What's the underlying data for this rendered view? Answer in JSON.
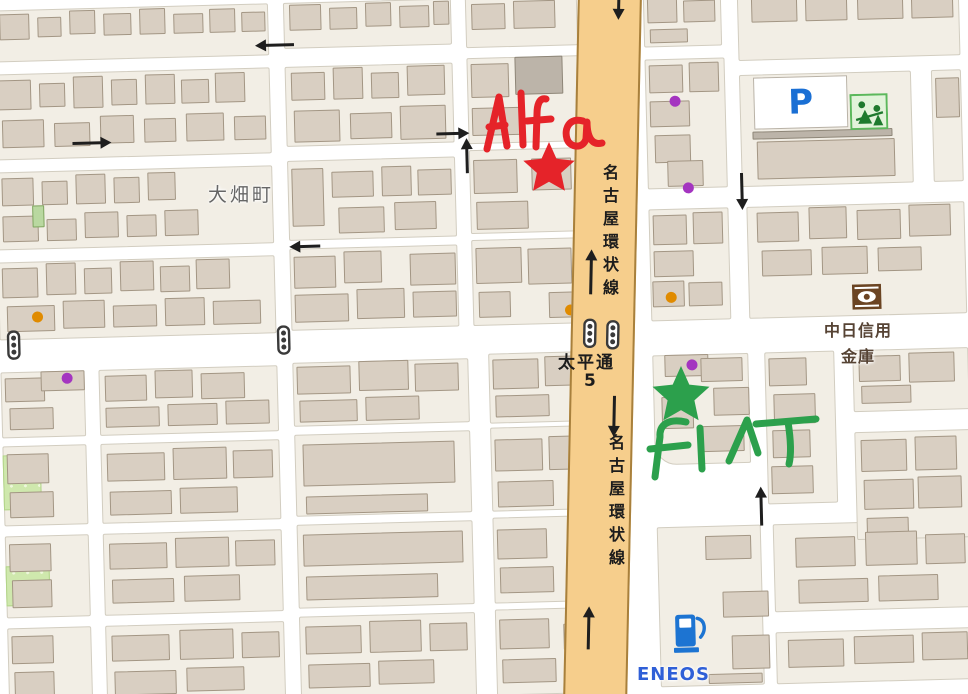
{
  "labels": {
    "town": "大畑町",
    "road_name": "名古屋環状線",
    "intersection_name": "太平通",
    "intersection_number": "5",
    "bank_line1": "中日信用",
    "bank_line2": "金庫",
    "parking": "P",
    "gas_station": "ENEOS"
  },
  "annotations": {
    "red_label": "Alfa",
    "green_label": "FIAT",
    "red_color": "#e52329",
    "green_color": "#2ca04c",
    "red_star": {
      "cx": 549,
      "cy": 169,
      "R": 27
    },
    "green_star": {
      "cx": 681,
      "cy": 396,
      "R": 30
    },
    "red_strokes": [
      "M487,149 L499,97 L507,146",
      "M489,127 L505,125",
      "M521,93 L523,145",
      "M546,99 C539,97 537,106 537,114 L536,147",
      "M527,121 L551,119",
      "M583,121 C569,117 564,129 567,139 C570,148 583,149 586,139 L587,122 C587,135 591,146 602,143"
    ],
    "green_strokes": [
      "M686,422 C668,418 659,425 660,437 L655,477",
      "M650,449 L688,445",
      "M700,428 L702,469",
      "M729,461 L747,420 L758,453",
      "M756,424 L816,419",
      "M788,422 C791,441 791,456 789,464"
    ]
  },
  "palette": {
    "street": "#ffffff",
    "block": "#f2eee5",
    "building": "#d9cfc2",
    "road": "#f6ce8c",
    "road_border": "#a8803c",
    "dot_orange": "#e08b00",
    "dot_purple": "#a435c0",
    "label_gray": "#666666",
    "bank_text": "#564334",
    "blue": "#2f5fd7",
    "icon_green": "#3f9e3f"
  },
  "geometry": {
    "road": {
      "x": 578,
      "y": -10,
      "w": 64,
      "h": 714,
      "rot": 1.2
    },
    "blocks": [
      [
        0,
        0,
        277,
        52
      ],
      [
        292,
        0,
        168,
        46
      ],
      [
        474,
        0,
        112,
        50
      ],
      [
        0,
        64,
        277,
        86
      ],
      [
        292,
        64,
        168,
        80
      ],
      [
        474,
        60,
        112,
        86
      ],
      [
        0,
        162,
        277,
        78
      ],
      [
        292,
        158,
        168,
        80
      ],
      [
        474,
        152,
        112,
        84
      ],
      [
        0,
        252,
        277,
        78
      ],
      [
        292,
        246,
        168,
        82
      ],
      [
        474,
        242,
        112,
        86
      ],
      [
        0,
        362,
        84,
        66
      ],
      [
        98,
        362,
        179,
        66
      ],
      [
        292,
        360,
        176,
        64
      ],
      [
        488,
        356,
        100,
        70
      ],
      [
        0,
        436,
        84,
        80
      ],
      [
        98,
        436,
        179,
        80
      ],
      [
        292,
        432,
        176,
        82
      ],
      [
        488,
        430,
        100,
        84
      ],
      [
        0,
        526,
        84,
        82
      ],
      [
        98,
        526,
        179,
        82
      ],
      [
        292,
        522,
        176,
        84
      ],
      [
        488,
        520,
        100,
        86
      ],
      [
        0,
        618,
        84,
        80
      ],
      [
        98,
        618,
        179,
        80
      ],
      [
        292,
        614,
        176,
        84
      ],
      [
        488,
        612,
        100,
        86
      ],
      [
        652,
        0,
        78,
        54
      ],
      [
        746,
        0,
        222,
        70
      ],
      [
        652,
        66,
        80,
        130
      ],
      [
        746,
        84,
        172,
        112
      ],
      [
        938,
        84,
        30,
        112
      ],
      [
        652,
        216,
        80,
        112
      ],
      [
        750,
        216,
        218,
        112
      ],
      [
        652,
        362,
        96,
        110,
        "rbl"
      ],
      [
        764,
        362,
        70,
        152
      ],
      [
        852,
        362,
        116,
        62
      ],
      [
        852,
        444,
        116,
        108
      ],
      [
        652,
        534,
        104,
        160
      ],
      [
        768,
        534,
        200,
        88
      ],
      [
        768,
        642,
        200,
        52
      ]
    ],
    "green_areas": [
      [
        0,
        445,
        38,
        55
      ],
      [
        0,
        556,
        44,
        40
      ]
    ],
    "buildings": [
      [
        8,
        4,
        30,
        26
      ],
      [
        46,
        8,
        24,
        20
      ],
      [
        78,
        2,
        26,
        24
      ],
      [
        112,
        6,
        28,
        22
      ],
      [
        148,
        2,
        26,
        26
      ],
      [
        182,
        8,
        30,
        20
      ],
      [
        218,
        4,
        26,
        24
      ],
      [
        250,
        8,
        24,
        20
      ],
      [
        298,
        2,
        32,
        26
      ],
      [
        338,
        6,
        28,
        22
      ],
      [
        374,
        2,
        26,
        24
      ],
      [
        408,
        6,
        30,
        22
      ],
      [
        442,
        2,
        16,
        24
      ],
      [
        480,
        6,
        34,
        26
      ],
      [
        522,
        4,
        42,
        28
      ],
      [
        4,
        70,
        34,
        30
      ],
      [
        46,
        74,
        26,
        24
      ],
      [
        80,
        68,
        30,
        32
      ],
      [
        118,
        72,
        26,
        26
      ],
      [
        152,
        68,
        30,
        30
      ],
      [
        188,
        74,
        28,
        24
      ],
      [
        222,
        68,
        30,
        30
      ],
      [
        8,
        110,
        42,
        28
      ],
      [
        60,
        114,
        36,
        24
      ],
      [
        106,
        108,
        34,
        28
      ],
      [
        150,
        112,
        32,
        24
      ],
      [
        192,
        108,
        38,
        28
      ],
      [
        240,
        112,
        32,
        24
      ],
      [
        298,
        70,
        34,
        28
      ],
      [
        340,
        66,
        30,
        32
      ],
      [
        378,
        72,
        28,
        26
      ],
      [
        414,
        66,
        38,
        30
      ],
      [
        300,
        108,
        46,
        32
      ],
      [
        356,
        112,
        42,
        26
      ],
      [
        406,
        106,
        46,
        34
      ],
      [
        478,
        66,
        38,
        34
      ],
      [
        478,
        110,
        52,
        28
      ],
      [
        522,
        60,
        48,
        38,
        "gray"
      ],
      [
        6,
        168,
        32,
        28
      ],
      [
        46,
        172,
        26,
        24
      ],
      [
        80,
        166,
        30,
        30
      ],
      [
        118,
        170,
        26,
        26
      ],
      [
        152,
        166,
        28,
        28
      ],
      [
        6,
        206,
        36,
        26
      ],
      [
        50,
        210,
        30,
        22
      ],
      [
        88,
        204,
        34,
        26
      ],
      [
        130,
        208,
        30,
        22
      ],
      [
        168,
        204,
        34,
        26
      ],
      [
        36,
        196,
        12,
        22,
        "green"
      ],
      [
        296,
        166,
        32,
        58
      ],
      [
        336,
        170,
        42,
        26
      ],
      [
        386,
        166,
        30,
        30
      ],
      [
        422,
        170,
        34,
        26
      ],
      [
        342,
        206,
        46,
        26
      ],
      [
        398,
        202,
        42,
        28
      ],
      [
        478,
        162,
        44,
        34
      ],
      [
        480,
        204,
        52,
        28
      ],
      [
        536,
        162,
        40,
        32
      ],
      [
        4,
        258,
        36,
        30
      ],
      [
        48,
        254,
        30,
        32
      ],
      [
        86,
        260,
        28,
        26
      ],
      [
        122,
        254,
        34,
        30
      ],
      [
        162,
        260,
        30,
        26
      ],
      [
        198,
        254,
        34,
        30
      ],
      [
        8,
        296,
        48,
        26
      ],
      [
        64,
        292,
        42,
        28
      ],
      [
        114,
        298,
        44,
        22
      ],
      [
        166,
        292,
        40,
        28
      ],
      [
        214,
        296,
        48,
        24
      ],
      [
        296,
        254,
        42,
        32
      ],
      [
        346,
        250,
        38,
        32
      ],
      [
        296,
        292,
        54,
        28
      ],
      [
        358,
        288,
        48,
        30
      ],
      [
        412,
        254,
        46,
        32
      ],
      [
        414,
        292,
        44,
        26
      ],
      [
        478,
        250,
        46,
        36
      ],
      [
        480,
        294,
        32,
        26
      ],
      [
        530,
        252,
        44,
        36
      ],
      [
        550,
        296,
        32,
        26
      ],
      [
        4,
        368,
        40,
        24
      ],
      [
        8,
        398,
        44,
        22
      ],
      [
        40,
        362,
        44,
        20
      ],
      [
        104,
        368,
        42,
        26
      ],
      [
        154,
        364,
        38,
        28
      ],
      [
        200,
        368,
        44,
        26
      ],
      [
        104,
        400,
        54,
        20
      ],
      [
        166,
        398,
        50,
        22
      ],
      [
        224,
        396,
        44,
        24
      ],
      [
        296,
        364,
        54,
        28
      ],
      [
        358,
        360,
        50,
        30
      ],
      [
        414,
        364,
        44,
        28
      ],
      [
        298,
        398,
        58,
        22
      ],
      [
        364,
        396,
        54,
        24
      ],
      [
        492,
        362,
        46,
        30
      ],
      [
        494,
        398,
        54,
        22
      ],
      [
        544,
        360,
        38,
        30
      ],
      [
        4,
        444,
        42,
        30
      ],
      [
        6,
        482,
        44,
        26
      ],
      [
        104,
        446,
        58,
        28
      ],
      [
        170,
        442,
        54,
        32
      ],
      [
        230,
        446,
        40,
        28
      ],
      [
        106,
        484,
        62,
        24
      ],
      [
        176,
        482,
        58,
        26
      ],
      [
        300,
        442,
        152,
        42
      ],
      [
        302,
        494,
        122,
        18
      ],
      [
        492,
        442,
        48,
        32
      ],
      [
        494,
        484,
        56,
        26
      ],
      [
        546,
        440,
        34,
        34
      ],
      [
        4,
        534,
        42,
        28
      ],
      [
        6,
        570,
        40,
        28
      ],
      [
        104,
        536,
        58,
        26
      ],
      [
        170,
        532,
        54,
        30
      ],
      [
        230,
        536,
        40,
        26
      ],
      [
        106,
        572,
        62,
        24
      ],
      [
        178,
        570,
        56,
        26
      ],
      [
        298,
        532,
        160,
        32
      ],
      [
        300,
        574,
        132,
        24
      ],
      [
        492,
        532,
        50,
        30
      ],
      [
        494,
        570,
        54,
        26
      ],
      [
        4,
        626,
        42,
        28
      ],
      [
        6,
        662,
        40,
        26
      ],
      [
        104,
        628,
        58,
        26
      ],
      [
        172,
        624,
        54,
        30
      ],
      [
        234,
        628,
        38,
        26
      ],
      [
        106,
        664,
        62,
        24
      ],
      [
        178,
        662,
        58,
        24
      ],
      [
        298,
        624,
        56,
        28
      ],
      [
        362,
        620,
        52,
        32
      ],
      [
        422,
        624,
        38,
        28
      ],
      [
        300,
        662,
        62,
        24
      ],
      [
        370,
        660,
        56,
        24
      ],
      [
        492,
        622,
        50,
        30
      ],
      [
        556,
        628,
        30,
        26
      ],
      [
        494,
        662,
        54,
        24
      ],
      [
        656,
        4,
        30,
        26
      ],
      [
        692,
        8,
        32,
        22
      ],
      [
        658,
        36,
        38,
        14
      ],
      [
        760,
        2,
        46,
        30
      ],
      [
        814,
        6,
        42,
        26
      ],
      [
        866,
        2,
        46,
        30
      ],
      [
        920,
        6,
        42,
        26
      ],
      [
        656,
        72,
        34,
        28
      ],
      [
        696,
        70,
        30,
        30
      ],
      [
        656,
        108,
        40,
        26
      ],
      [
        660,
        142,
        36,
        28
      ],
      [
        672,
        168,
        36,
        26
      ],
      [
        758,
        141,
        140,
        8,
        "gray"
      ],
      [
        762,
        151,
        138,
        38
      ],
      [
        942,
        92,
        24,
        40
      ],
      [
        656,
        222,
        34,
        30
      ],
      [
        696,
        220,
        30,
        32
      ],
      [
        656,
        258,
        40,
        26
      ],
      [
        654,
        288,
        32,
        26
      ],
      [
        690,
        290,
        34,
        24
      ],
      [
        760,
        222,
        42,
        30
      ],
      [
        812,
        218,
        38,
        32
      ],
      [
        860,
        222,
        44,
        30
      ],
      [
        912,
        218,
        42,
        32
      ],
      [
        764,
        260,
        50,
        26
      ],
      [
        824,
        258,
        46,
        28
      ],
      [
        880,
        260,
        44,
        24
      ],
      [
        664,
        362,
        44,
        22
      ],
      [
        700,
        366,
        42,
        24
      ],
      [
        712,
        396,
        36,
        28
      ],
      [
        660,
        404,
        32,
        32
      ],
      [
        700,
        434,
        42,
        26
      ],
      [
        768,
        368,
        38,
        28
      ],
      [
        772,
        404,
        42,
        30
      ],
      [
        770,
        440,
        38,
        28
      ],
      [
        768,
        476,
        42,
        28
      ],
      [
        858,
        368,
        42,
        26
      ],
      [
        908,
        366,
        46,
        30
      ],
      [
        860,
        398,
        50,
        18
      ],
      [
        858,
        452,
        46,
        32
      ],
      [
        912,
        450,
        42,
        34
      ],
      [
        860,
        492,
        50,
        30
      ],
      [
        914,
        490,
        44,
        32
      ],
      [
        862,
        530,
        42,
        16
      ],
      [
        700,
        544,
        46,
        24
      ],
      [
        716,
        600,
        46,
        26
      ],
      [
        724,
        644,
        38,
        34
      ],
      [
        700,
        682,
        54,
        10
      ],
      [
        790,
        548,
        60,
        30
      ],
      [
        860,
        544,
        52,
        34
      ],
      [
        920,
        548,
        40,
        30
      ],
      [
        792,
        590,
        70,
        24
      ],
      [
        872,
        588,
        60,
        26
      ],
      [
        780,
        650,
        56,
        28
      ],
      [
        846,
        648,
        60,
        28
      ],
      [
        914,
        646,
        46,
        28
      ]
    ],
    "dots": [
      {
        "x": 33,
        "y": 302,
        "c": "orange"
      },
      {
        "x": 566,
        "y": 309,
        "c": "orange"
      },
      {
        "x": 667,
        "y": 299,
        "c": "orange"
      },
      {
        "x": 61,
        "y": 364,
        "c": "purple"
      },
      {
        "x": 676,
        "y": 103,
        "c": "purple"
      },
      {
        "x": 687,
        "y": 190,
        "c": "purple"
      },
      {
        "x": 686,
        "y": 367,
        "c": "purple"
      },
      {
        "x": 578,
        "y": 646,
        "c": "purple"
      }
    ],
    "traffic_lights": [
      {
        "x": 7,
        "y": 320
      },
      {
        "x": 277,
        "y": 322
      }
    ],
    "road_lights": [
      {
        "x": 10,
        "y": 328
      },
      {
        "x": 33,
        "y": 329
      }
    ],
    "arrows": [
      {
        "x": 283,
        "y": 42,
        "dir": "left",
        "len": 28
      },
      {
        "x": 97,
        "y": 135,
        "dir": "right",
        "len": 28
      },
      {
        "x": 458,
        "y": 135,
        "dir": "right",
        "len": 22
      },
      {
        "x": 472,
        "y": 158,
        "dir": "up",
        "len": 24
      },
      {
        "x": 308,
        "y": 244,
        "dir": "left",
        "len": 20
      },
      {
        "x": 746,
        "y": 200,
        "dir": "down",
        "len": 26
      },
      {
        "x": 757,
        "y": 516,
        "dir": "up",
        "len": 28
      }
    ],
    "road_arrows": [
      {
        "x": 39,
        "y": 16,
        "dir": "down",
        "len": 14
      },
      {
        "x": 17,
        "y": 282,
        "dir": "up",
        "len": 34
      },
      {
        "x": 43,
        "y": 425,
        "dir": "down",
        "len": 30
      },
      {
        "x": 22,
        "y": 638,
        "dir": "up",
        "len": 32
      }
    ],
    "parking": {
      "x": 760,
      "y": 87,
      "w": 92,
      "h": 50
    },
    "icons": {
      "bank": {
        "x": 853,
        "y": 296
      },
      "pump": {
        "x": 666,
        "y": 618
      },
      "park": {
        "x": 856,
        "y": 106
      }
    }
  },
  "label_positions": {
    "lbl-town": {
      "x": 208,
      "y": 180
    },
    "lbl-roadname1": {
      "x": 597,
      "y": 164
    },
    "lbl-roadname2": {
      "x": 603,
      "y": 434
    },
    "lbl-taihei": {
      "x": 558,
      "y": 348
    },
    "lbl-taihei-num": {
      "x": 584,
      "y": 371
    },
    "lbl-bank1": {
      "x": 824,
      "y": 317
    },
    "lbl-bank2": {
      "x": 841,
      "y": 343
    },
    "lbl-eneos": {
      "x": 637,
      "y": 664
    }
  }
}
